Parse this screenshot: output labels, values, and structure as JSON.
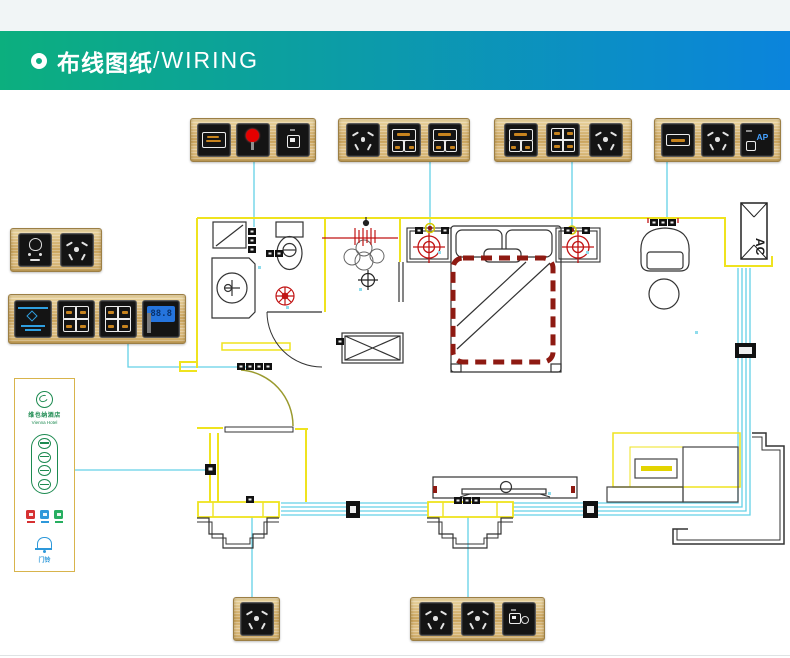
{
  "header": {
    "title_zh": "布线图纸",
    "title_en": "/WIRING",
    "gradient_left": "#0caf7e",
    "gradient_right": "#0b84dc",
    "top_strip_color": "#f1f5f6"
  },
  "colors": {
    "panel_gold": "#d8b87a",
    "module_black": "#141414",
    "wire_cyan": "#63d1e6",
    "wall_yellow": "#efe31f",
    "cad_red": "#c11414",
    "bed_dash_red": "#8e1a12",
    "lcd_blue": "#2574dd",
    "switch_label_orange": "#c8841e",
    "ap_blue": "#45a1ff",
    "logo_green": "#1c8a50",
    "icon_red": "#d63031",
    "icon_blue": "#2d98da",
    "icon_green": "#27ae60"
  },
  "floor_plan": {
    "ac_label": "AC"
  },
  "logo_panel": {
    "hotel_name_zh": "维也纳酒店",
    "hotel_name_en": "Vienna Hotel",
    "doorbell_label": "门铃",
    "status_icons": [
      "do-not-disturb-red",
      "please-clean-blue",
      "eco-green"
    ]
  },
  "panels": [
    {
      "id": "top-1",
      "modules": [
        {
          "type": "room-number-display"
        },
        {
          "type": "doorbell-red-button"
        },
        {
          "type": "doorbell-unit"
        }
      ]
    },
    {
      "id": "top-2",
      "modules": [
        {
          "type": "five-hole-socket"
        },
        {
          "type": "switch-2gang-labeled"
        },
        {
          "type": "switch-2gang-labeled"
        }
      ]
    },
    {
      "id": "top-3",
      "modules": [
        {
          "type": "switch-2gang-labeled"
        },
        {
          "type": "switch-4gang-labeled"
        },
        {
          "type": "five-hole-socket"
        }
      ]
    },
    {
      "id": "top-4",
      "modules": [
        {
          "type": "label-display"
        },
        {
          "type": "five-hole-socket"
        },
        {
          "type": "ap-module",
          "label": "AP"
        }
      ]
    },
    {
      "id": "left-1",
      "modules": [
        {
          "type": "shaver-socket"
        },
        {
          "type": "five-hole-socket"
        }
      ]
    },
    {
      "id": "left-2",
      "modules": [
        {
          "type": "keycard-power"
        },
        {
          "type": "switch-4gang-labeled"
        },
        {
          "type": "switch-4gang-labeled"
        },
        {
          "type": "thermostat",
          "display": "88.8"
        }
      ]
    },
    {
      "id": "bottom-1",
      "modules": [
        {
          "type": "five-hole-socket"
        }
      ]
    },
    {
      "id": "bottom-2",
      "modules": [
        {
          "type": "five-hole-socket"
        },
        {
          "type": "five-hole-socket"
        },
        {
          "type": "tv-network-jack"
        }
      ]
    }
  ]
}
